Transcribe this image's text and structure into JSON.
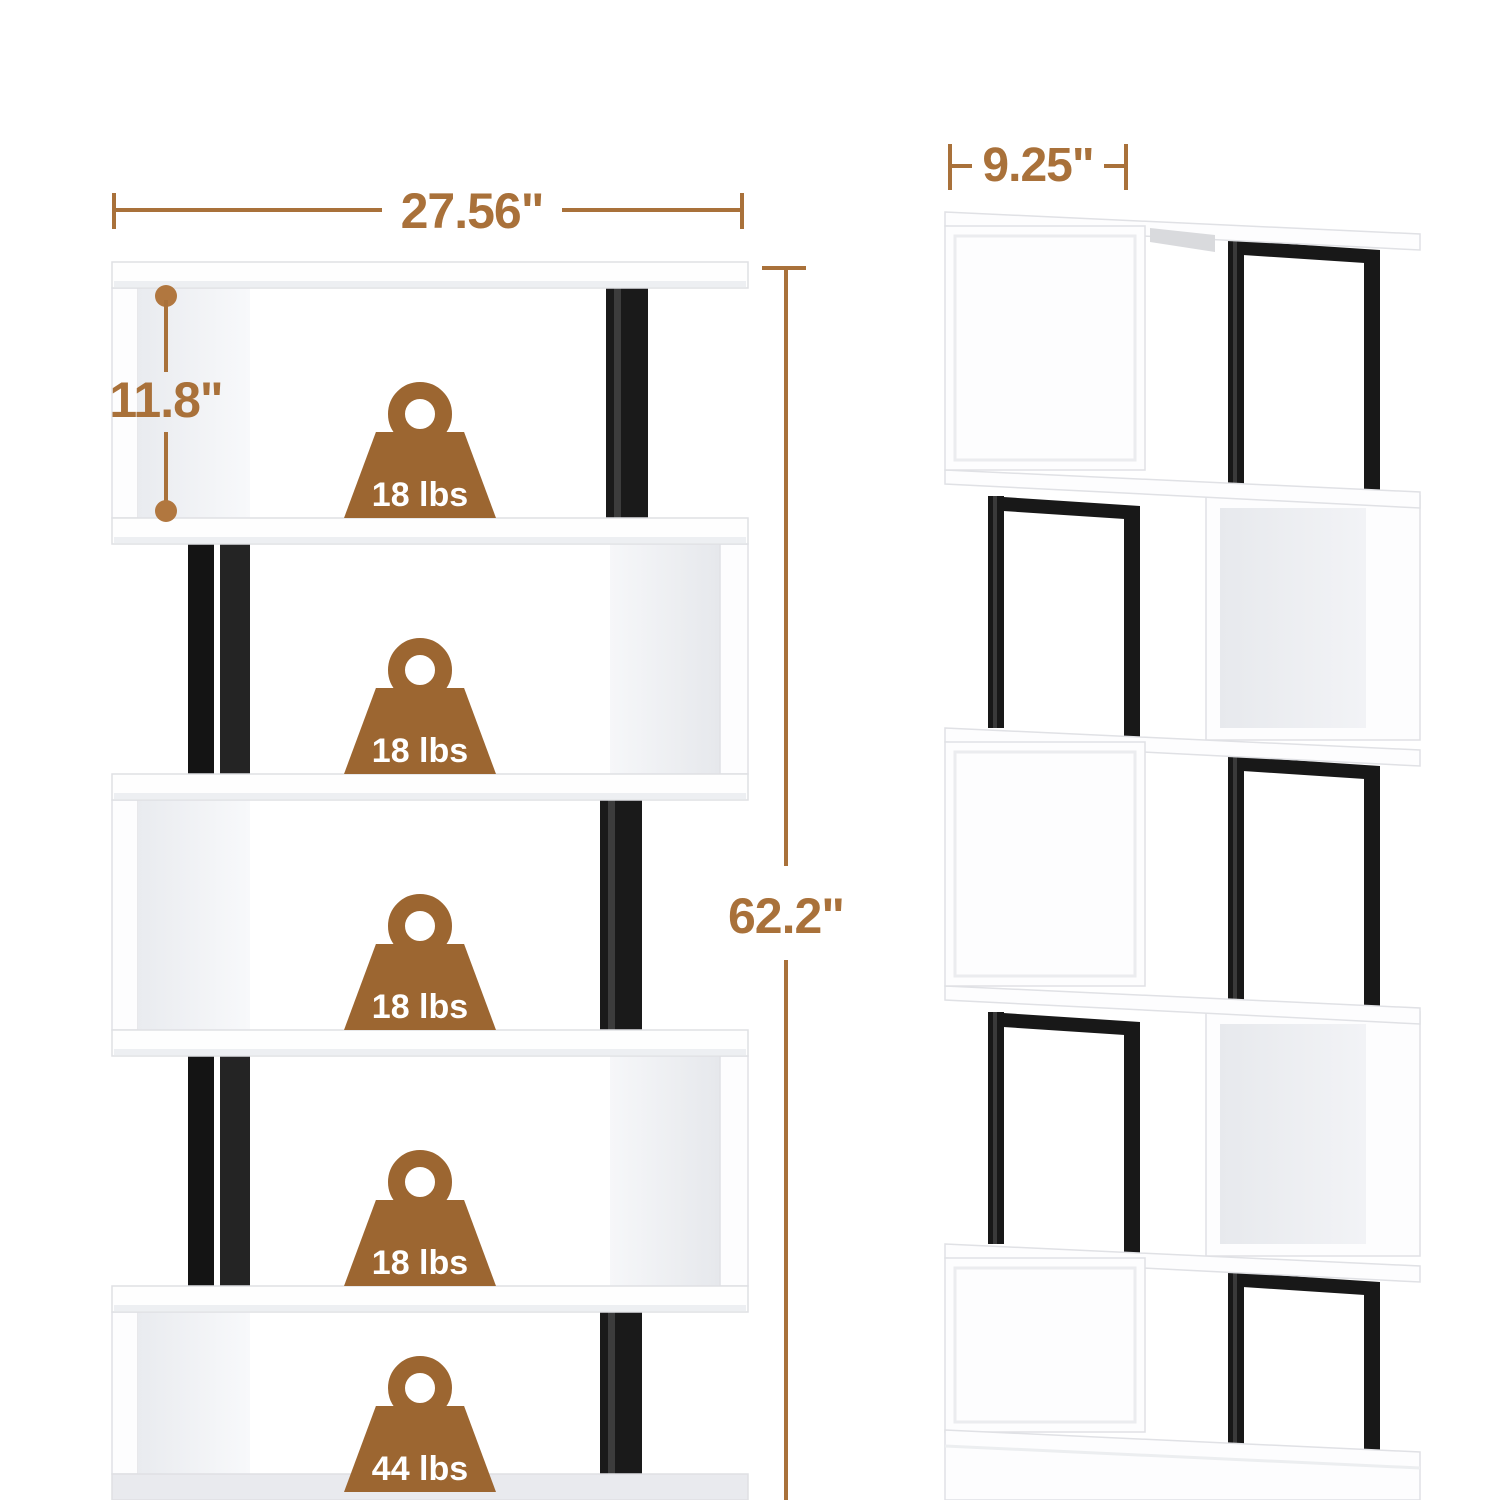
{
  "figure": {
    "front_view": {
      "width_label": "27.56\"",
      "tier_height_label": "11.8\"",
      "overall_height_label": "62.2\"",
      "tier_capacities": [
        {
          "label": "18 lbs"
        },
        {
          "label": "18 lbs"
        },
        {
          "label": "18 lbs"
        },
        {
          "label": "18 lbs"
        },
        {
          "label": "44 lbs"
        }
      ]
    },
    "side_view": {
      "depth_label": "9.25\""
    },
    "colors": {
      "dimension_annotation": "#a9713a",
      "weight_badge_brown": "#9c6631",
      "metal_frame_black": "#181818",
      "panel_white": "#fdfdfe",
      "panel_shadow_gray": "#e9ebef"
    }
  }
}
